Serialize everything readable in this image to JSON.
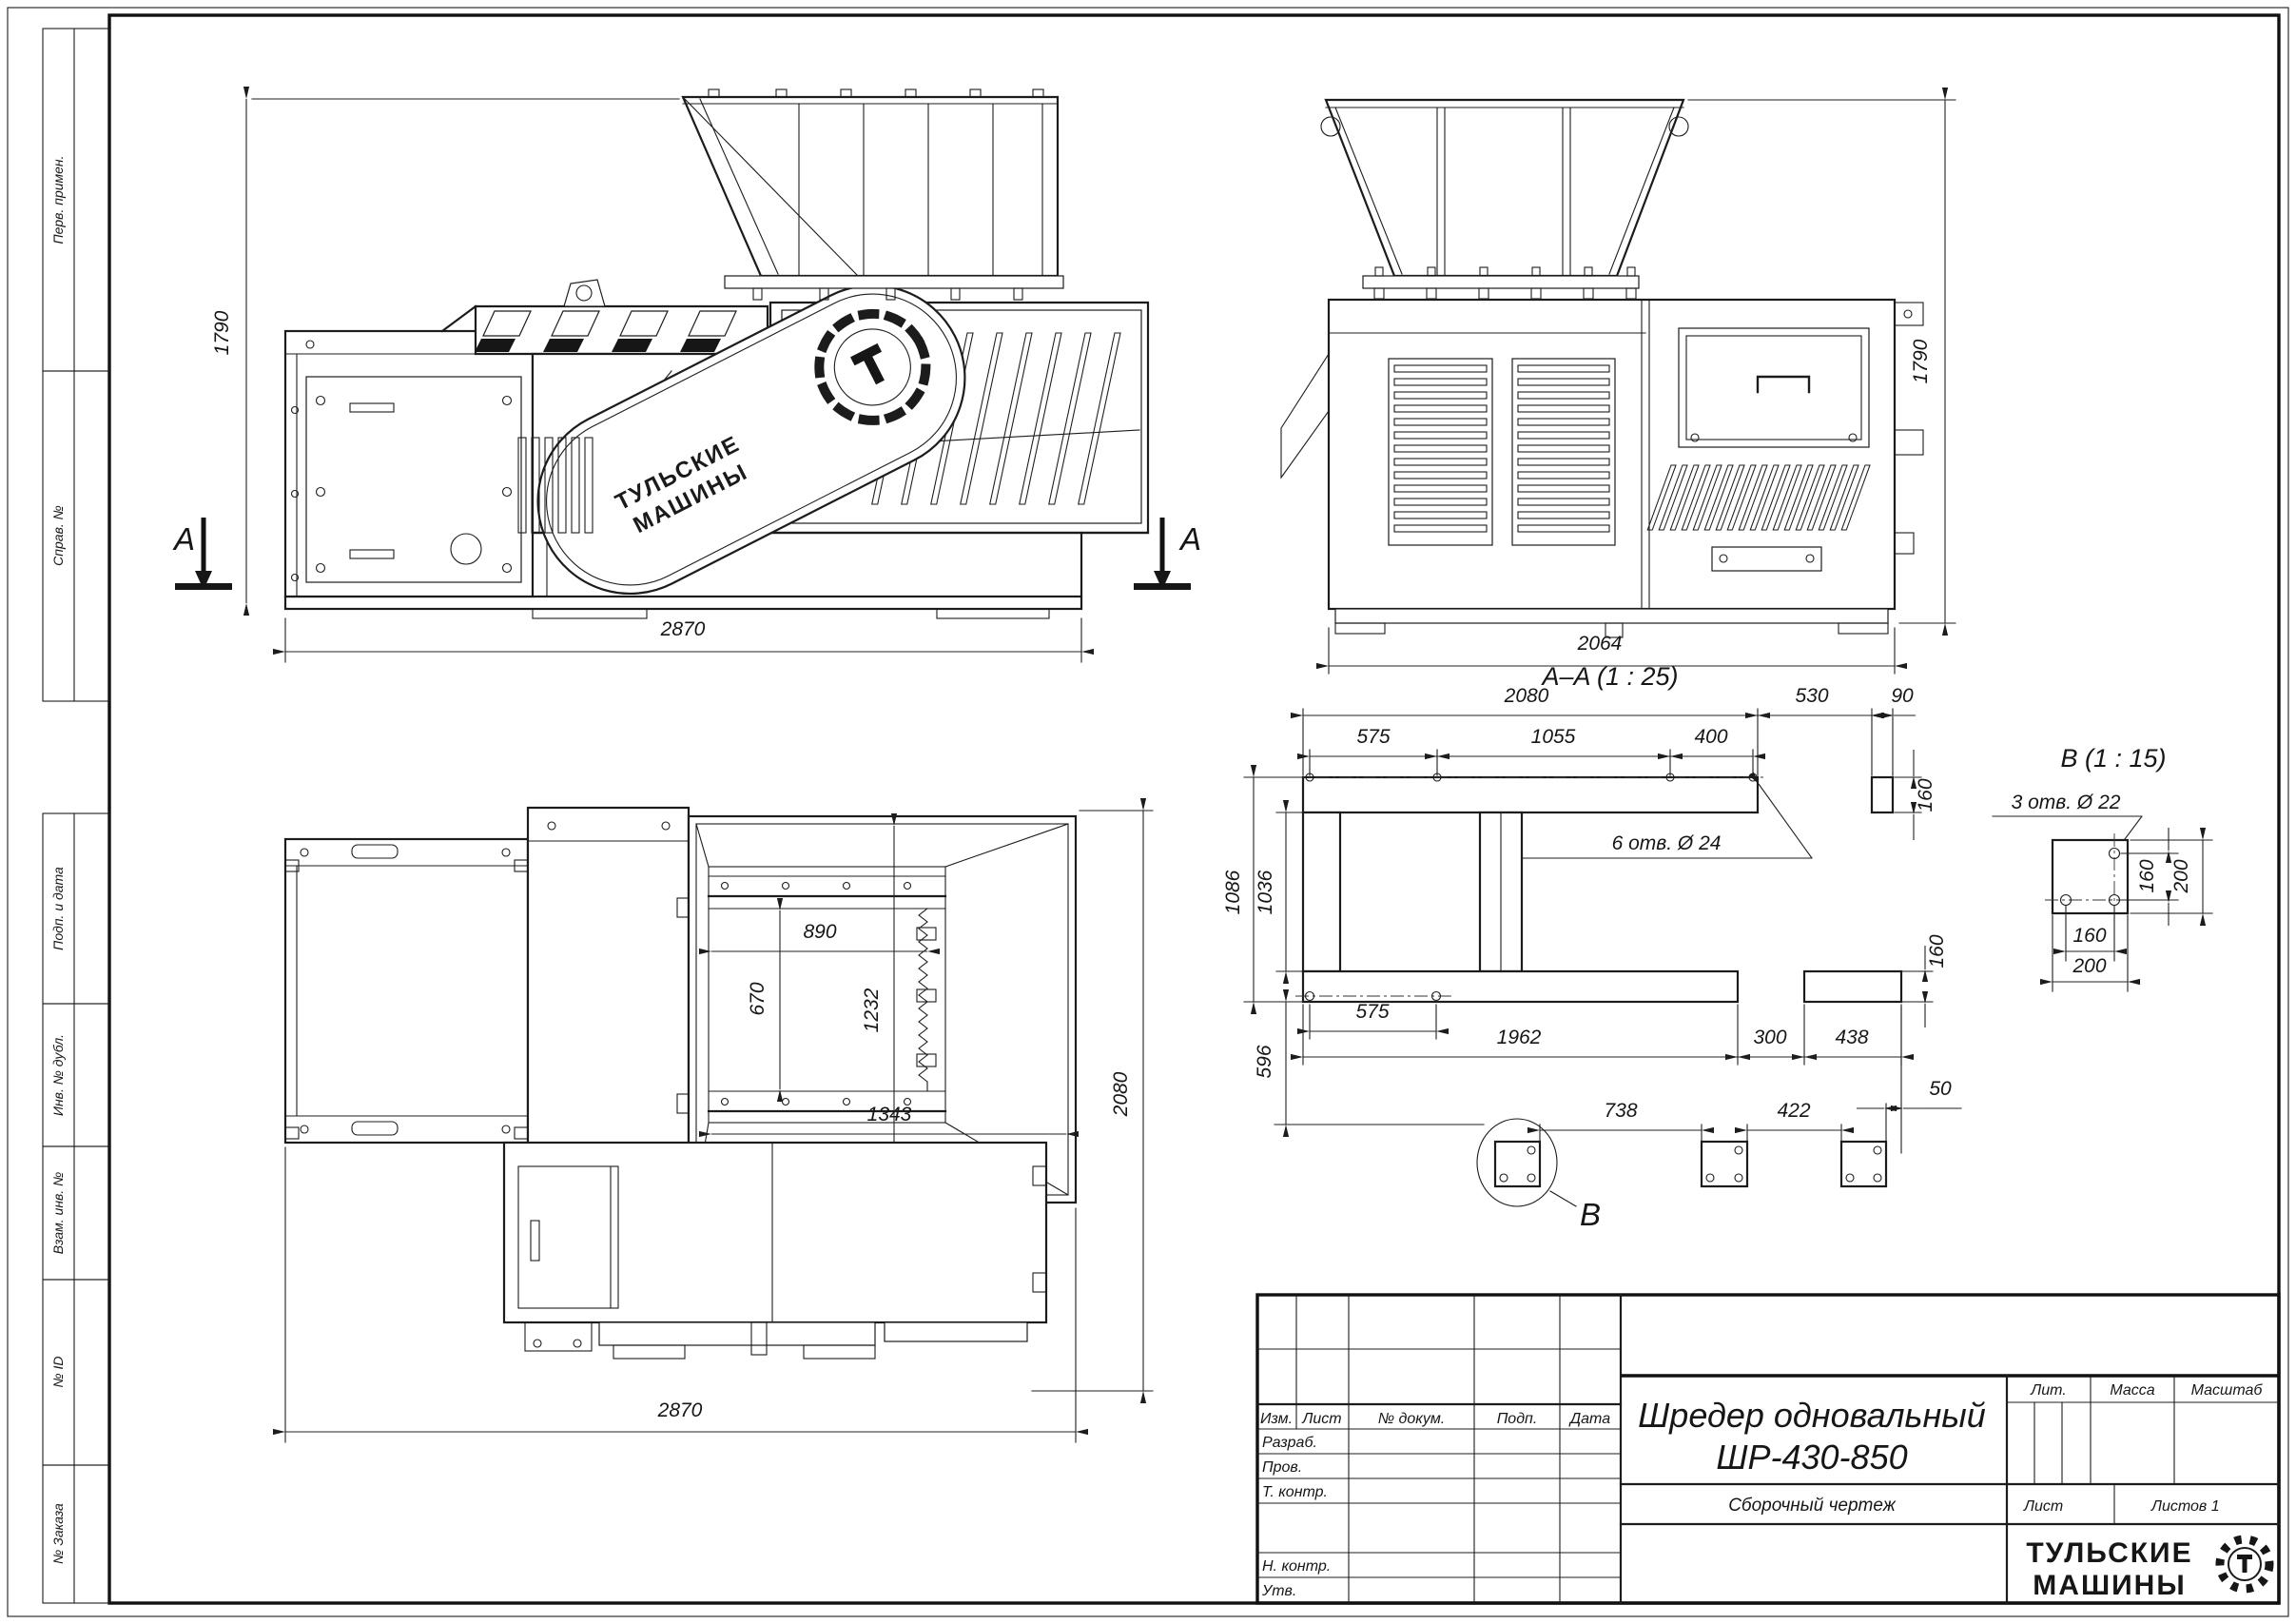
{
  "sheet": {
    "margin_labels": [
      "Перв. примен.",
      "Справ. №",
      "Подп. и дата",
      "Инв. № дубл.",
      "Взам. инв. №",
      "№ ID",
      "№ Заказа"
    ]
  },
  "title_block": {
    "columns": [
      "Изм.",
      "Лист",
      "№ докум.",
      "Подп.",
      "Дата"
    ],
    "rows": [
      "Разраб.",
      "Пров.",
      "Т. контр.",
      "Н. контр.",
      "Утв."
    ],
    "title_line1": "Шредер одновальный",
    "title_line2": "ШР-430-850",
    "subtitle": "Сборочный чертеж",
    "lit": "Лит.",
    "mass": "Масса",
    "scale": "Масштаб",
    "sheet": "Лист",
    "sheets": "Листов 1",
    "brand_line1": "ТУЛЬСКИЕ",
    "brand_line2": "МАШИНЫ"
  },
  "views": {
    "front": {
      "height": "1790",
      "width": "2870",
      "section_mark": "A",
      "guard_brand1": "ТУЛЬСКИЕ",
      "guard_brand2": "МАШИНЫ"
    },
    "side": {
      "height": "1790",
      "width": "2064"
    },
    "plan": {
      "width": "2870",
      "depth": "2080",
      "open_width": "890",
      "open_depth": "670",
      "inner_width": "1343",
      "inner_depth": "1232"
    },
    "section_aa": {
      "title": "A–A (1 : 25)",
      "hole_note": "6 отв. Ø 24",
      "top_total": "2080",
      "top_530": "530",
      "top_90": "90",
      "seg_575": "575",
      "seg_1055": "1055",
      "seg_400": "400",
      "right_160_top": "160",
      "left_1086": "1086",
      "left_1036": "1036",
      "left_596": "596",
      "bottom_575": "575",
      "bottom_1962": "1962",
      "bottom_300": "300",
      "bottom_438": "438",
      "right_160_bottom": "160",
      "feet_738": "738",
      "feet_422": "422",
      "feet_50": "50",
      "detail_mark": "B"
    },
    "detail_b": {
      "title": "B (1 : 15)",
      "hole_note": "3 отв. Ø 22",
      "v160": "160",
      "v200": "200",
      "h160": "160",
      "h200": "200"
    }
  }
}
